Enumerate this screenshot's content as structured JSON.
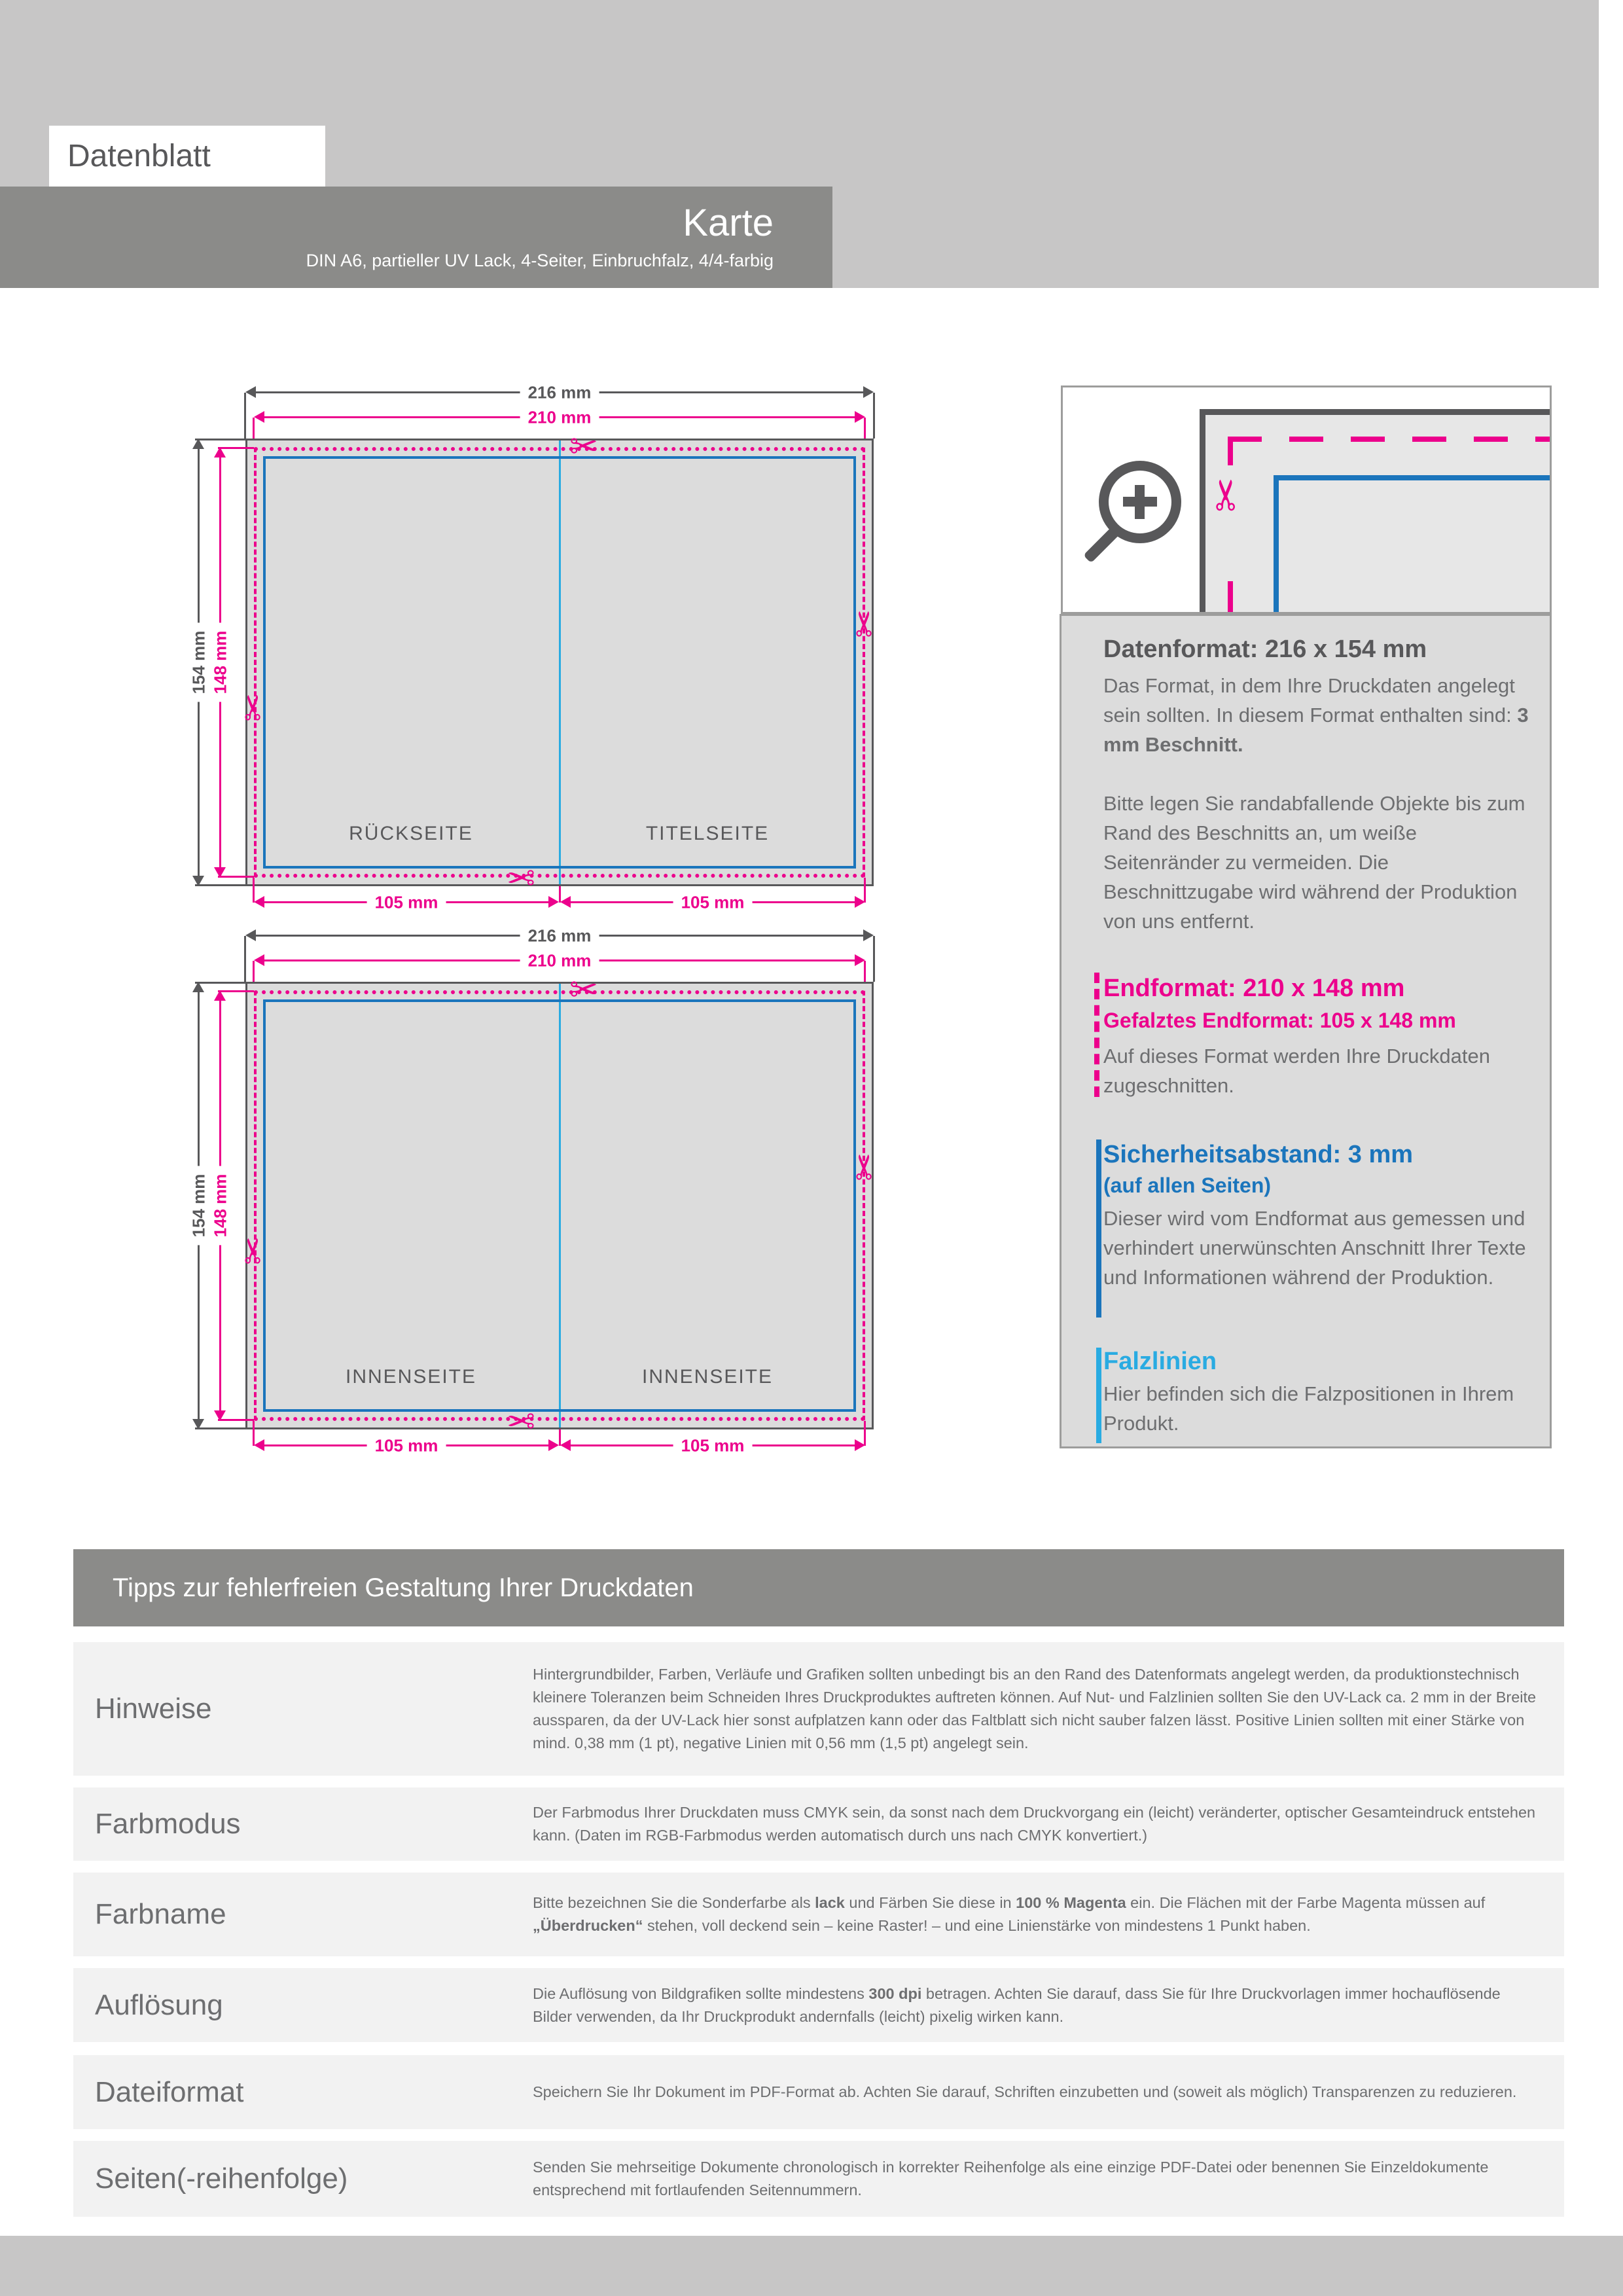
{
  "header": {
    "sheet_label": "Datenblatt",
    "product_title": "Karte",
    "product_subtitle": "DIN A6, partieller UV Lack, 4-Seiter, Einbruchfalz, 4/4-farbig"
  },
  "icons": {
    "scissors": "✂"
  },
  "diagrams": [
    {
      "dim_outer_width": "216 mm",
      "dim_inner_width": "210 mm",
      "dim_outer_height": "154 mm",
      "dim_inner_height": "148 mm",
      "dim_half_left": "105 mm",
      "dim_half_right": "105 mm",
      "page_left": "RÜCKSEITE",
      "page_right": "TITELSEITE"
    },
    {
      "dim_outer_width": "216 mm",
      "dim_inner_width": "210 mm",
      "dim_outer_height": "154 mm",
      "dim_inner_height": "148 mm",
      "dim_half_left": "105 mm",
      "dim_half_right": "105 mm",
      "page_left": "INNENSEITE",
      "page_right": "INNENSEITE"
    }
  ],
  "info": {
    "datenformat": {
      "title": "Datenformat: 216 x 154 mm",
      "body_intro": "Das Format, in dem Ihre Druckdaten angelegt sein sollten. In diesem Format enthalten sind: ",
      "body_bold": "3 mm Beschnitt.",
      "body_more": "Bitte legen Sie randabfallende Objekte bis zum Rand des Beschnitts an, um weiße Seitenränder zu vermeiden. Die Beschnittzugabe wird während der Produktion von uns entfernt."
    },
    "endformat": {
      "title": "Endformat: 210 x 148 mm",
      "subtitle": "Gefalztes Endformat: 105 x 148 mm",
      "body": "Auf dieses Format werden Ihre Druckdaten zugeschnitten."
    },
    "safety": {
      "title": "Sicherheitsabstand: 3 mm",
      "subtitle": "(auf allen Seiten)",
      "body": "Dieser wird vom Endformat aus gemessen und verhindert unerwünschten Anschnitt Ihrer Texte und Informationen während der Produktion."
    },
    "falzlinien": {
      "title": "Falzlinien",
      "body": "Hier befinden sich die Falzpositionen in Ihrem Produkt."
    }
  },
  "tips": {
    "title": "Tipps zur fehlerfreien Gestaltung Ihrer Druckdaten",
    "rows": [
      {
        "label": "Hinweise",
        "text": "Hintergrundbilder, Farben, Verläufe und Grafiken sollten unbedingt bis an den Rand des Datenformats angelegt werden, da produktionstechnisch kleinere Toleranzen beim Schneiden Ihres Druckproduktes auftreten können. Auf Nut- und Falzlinien sollten Sie den UV-Lack ca. 2 mm in der Breite aussparen, da der UV-Lack hier sonst aufplatzen kann oder das Faltblatt sich nicht sauber falzen lässt. Positive Linien sollten mit einer Stärke von mind. 0,38 mm (1 pt), negative Linien mit 0,56 mm (1,5 pt) angelegt sein."
      },
      {
        "label": "Farbmodus",
        "text": "Der Farbmodus Ihrer Druckdaten muss CMYK sein, da sonst nach dem Druckvorgang ein (leicht) veränderter, optischer Gesamteindruck entstehen kann. (Daten im RGB-Farbmodus werden automatisch durch uns nach CMYK konvertiert.)"
      },
      {
        "label": "Farbname",
        "t1": "Bitte bezeichnen Sie die Sonderfarbe als ",
        "b1": "lack",
        "t2": " und Färben Sie diese in ",
        "b2": "100 % Magenta",
        "t3": " ein. Die Flächen mit der Farbe Magenta müssen auf ",
        "b3": "„Überdrucken“",
        "t4": " stehen, voll deckend sein – keine Raster! – und eine Linienstärke von mindestens 1 Punkt haben."
      },
      {
        "label": "Auflösung",
        "t1": "Die Auflösung von Bildgrafiken sollte mindestens ",
        "b1": "300 dpi",
        "t2": " betragen. Achten Sie darauf, dass Sie für Ihre Druckvorlagen immer hochauflösende Bilder verwenden, da Ihr Druckprodukt andernfalls (leicht) pixelig wirken kann."
      },
      {
        "label": "Dateiformat",
        "text": "Speichern Sie Ihr Dokument im PDF-Format ab. Achten Sie darauf, Schriften einzubetten und (soweit als möglich) Transparenzen zu reduzieren."
      },
      {
        "label": "Seiten(-reihenfolge)",
        "text": "Senden Sie mehrseitige Dokumente chronologisch in korrekter Reihenfolge als eine einzige PDF-Datei oder benennen Sie Einzeldokumente entsprechend mit fortlaufenden Seitennummern."
      }
    ]
  },
  "colors": {
    "magenta": "#ec008c",
    "safety_blue": "#1b75bc",
    "fold_cyan": "#29abe2",
    "dark_gray": "#58585a",
    "band_gray": "#8b8b89",
    "light_gray": "#c7c6c6",
    "panel_gray": "#dcdcdc",
    "row_gray": "#f2f2f2",
    "text_gray": "#6d6e70"
  }
}
